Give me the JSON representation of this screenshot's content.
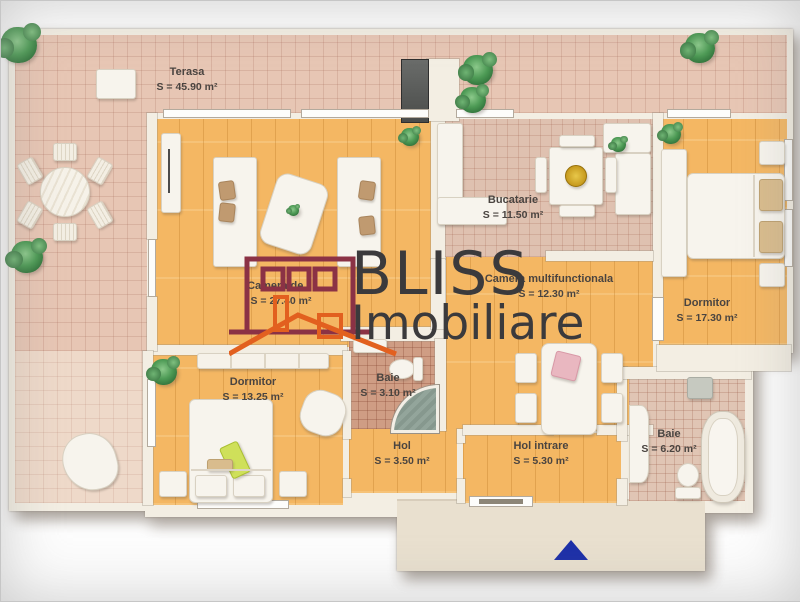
{
  "brand": {
    "line1": "BLISS",
    "line2": "Imobiliare"
  },
  "rooms": [
    {
      "name": "Terasa",
      "area": "S = 45.90 m²"
    },
    {
      "name": "Camera de zi",
      "area": "S = 27.40 m²"
    },
    {
      "name": "Bucatarie",
      "area": "S = 11.50 m²"
    },
    {
      "name": "Camera multifunctionala",
      "area": "S = 12.30 m²"
    },
    {
      "name": "Dormitor",
      "area": "S = 17.30 m²"
    },
    {
      "name": "Dormitor",
      "area": "S = 13.25 m²"
    },
    {
      "name": "Baie",
      "area": "S = 3.10 m²"
    },
    {
      "name": "Hol",
      "area": "S = 3.50 m²"
    },
    {
      "name": "Hol intrare",
      "area": "S = 5.30 m²"
    },
    {
      "name": "Baie",
      "area": "S = 6.20 m²"
    }
  ],
  "colors": {
    "wall": "#f3eee3",
    "platform": "#e9e0cf",
    "wood": "#f4b763",
    "terrace_tile": "#e7c6b4",
    "terrace_tile_light": "#eed9c9",
    "kitchen_tile": "#dfc1b0",
    "bath_small_tile": "#cf9d84",
    "bath_big_tile": "#e0c5b4",
    "label_text": "#4a4440",
    "brand_text": "#3b3a3c",
    "logo_maroon": "#8b3245",
    "logo_orange": "#e2601f",
    "arrow_blue": "#1c2fa8",
    "plant_green": "#4d9a55"
  }
}
